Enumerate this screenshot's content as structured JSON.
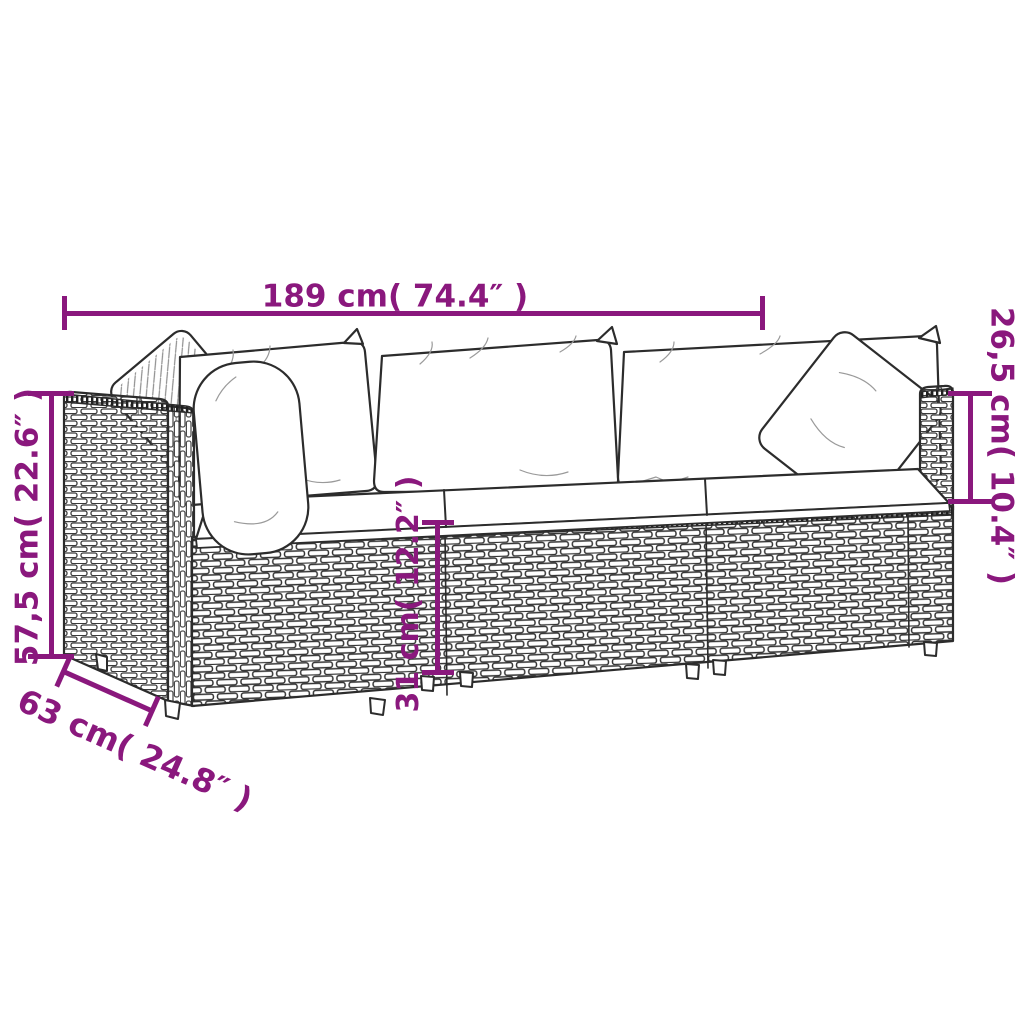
{
  "illustration": {
    "name": "rattan-garden-sofa-set-line-drawing"
  },
  "colors": {
    "dimension_accent": "#8a187d",
    "line_art": "#2c2c2c",
    "background": "#ffffff"
  },
  "dimensions": {
    "top": {
      "label": "189 cm( 74.4″ )"
    },
    "left": {
      "label": "57,5 cm( 22.6″ )"
    },
    "right": {
      "label": "26,5 cm( 10.4″ )"
    },
    "middle": {
      "label": "31 cm( 12.2″ )"
    },
    "bottom": {
      "label": "63 cm( 24.8″ )"
    }
  }
}
